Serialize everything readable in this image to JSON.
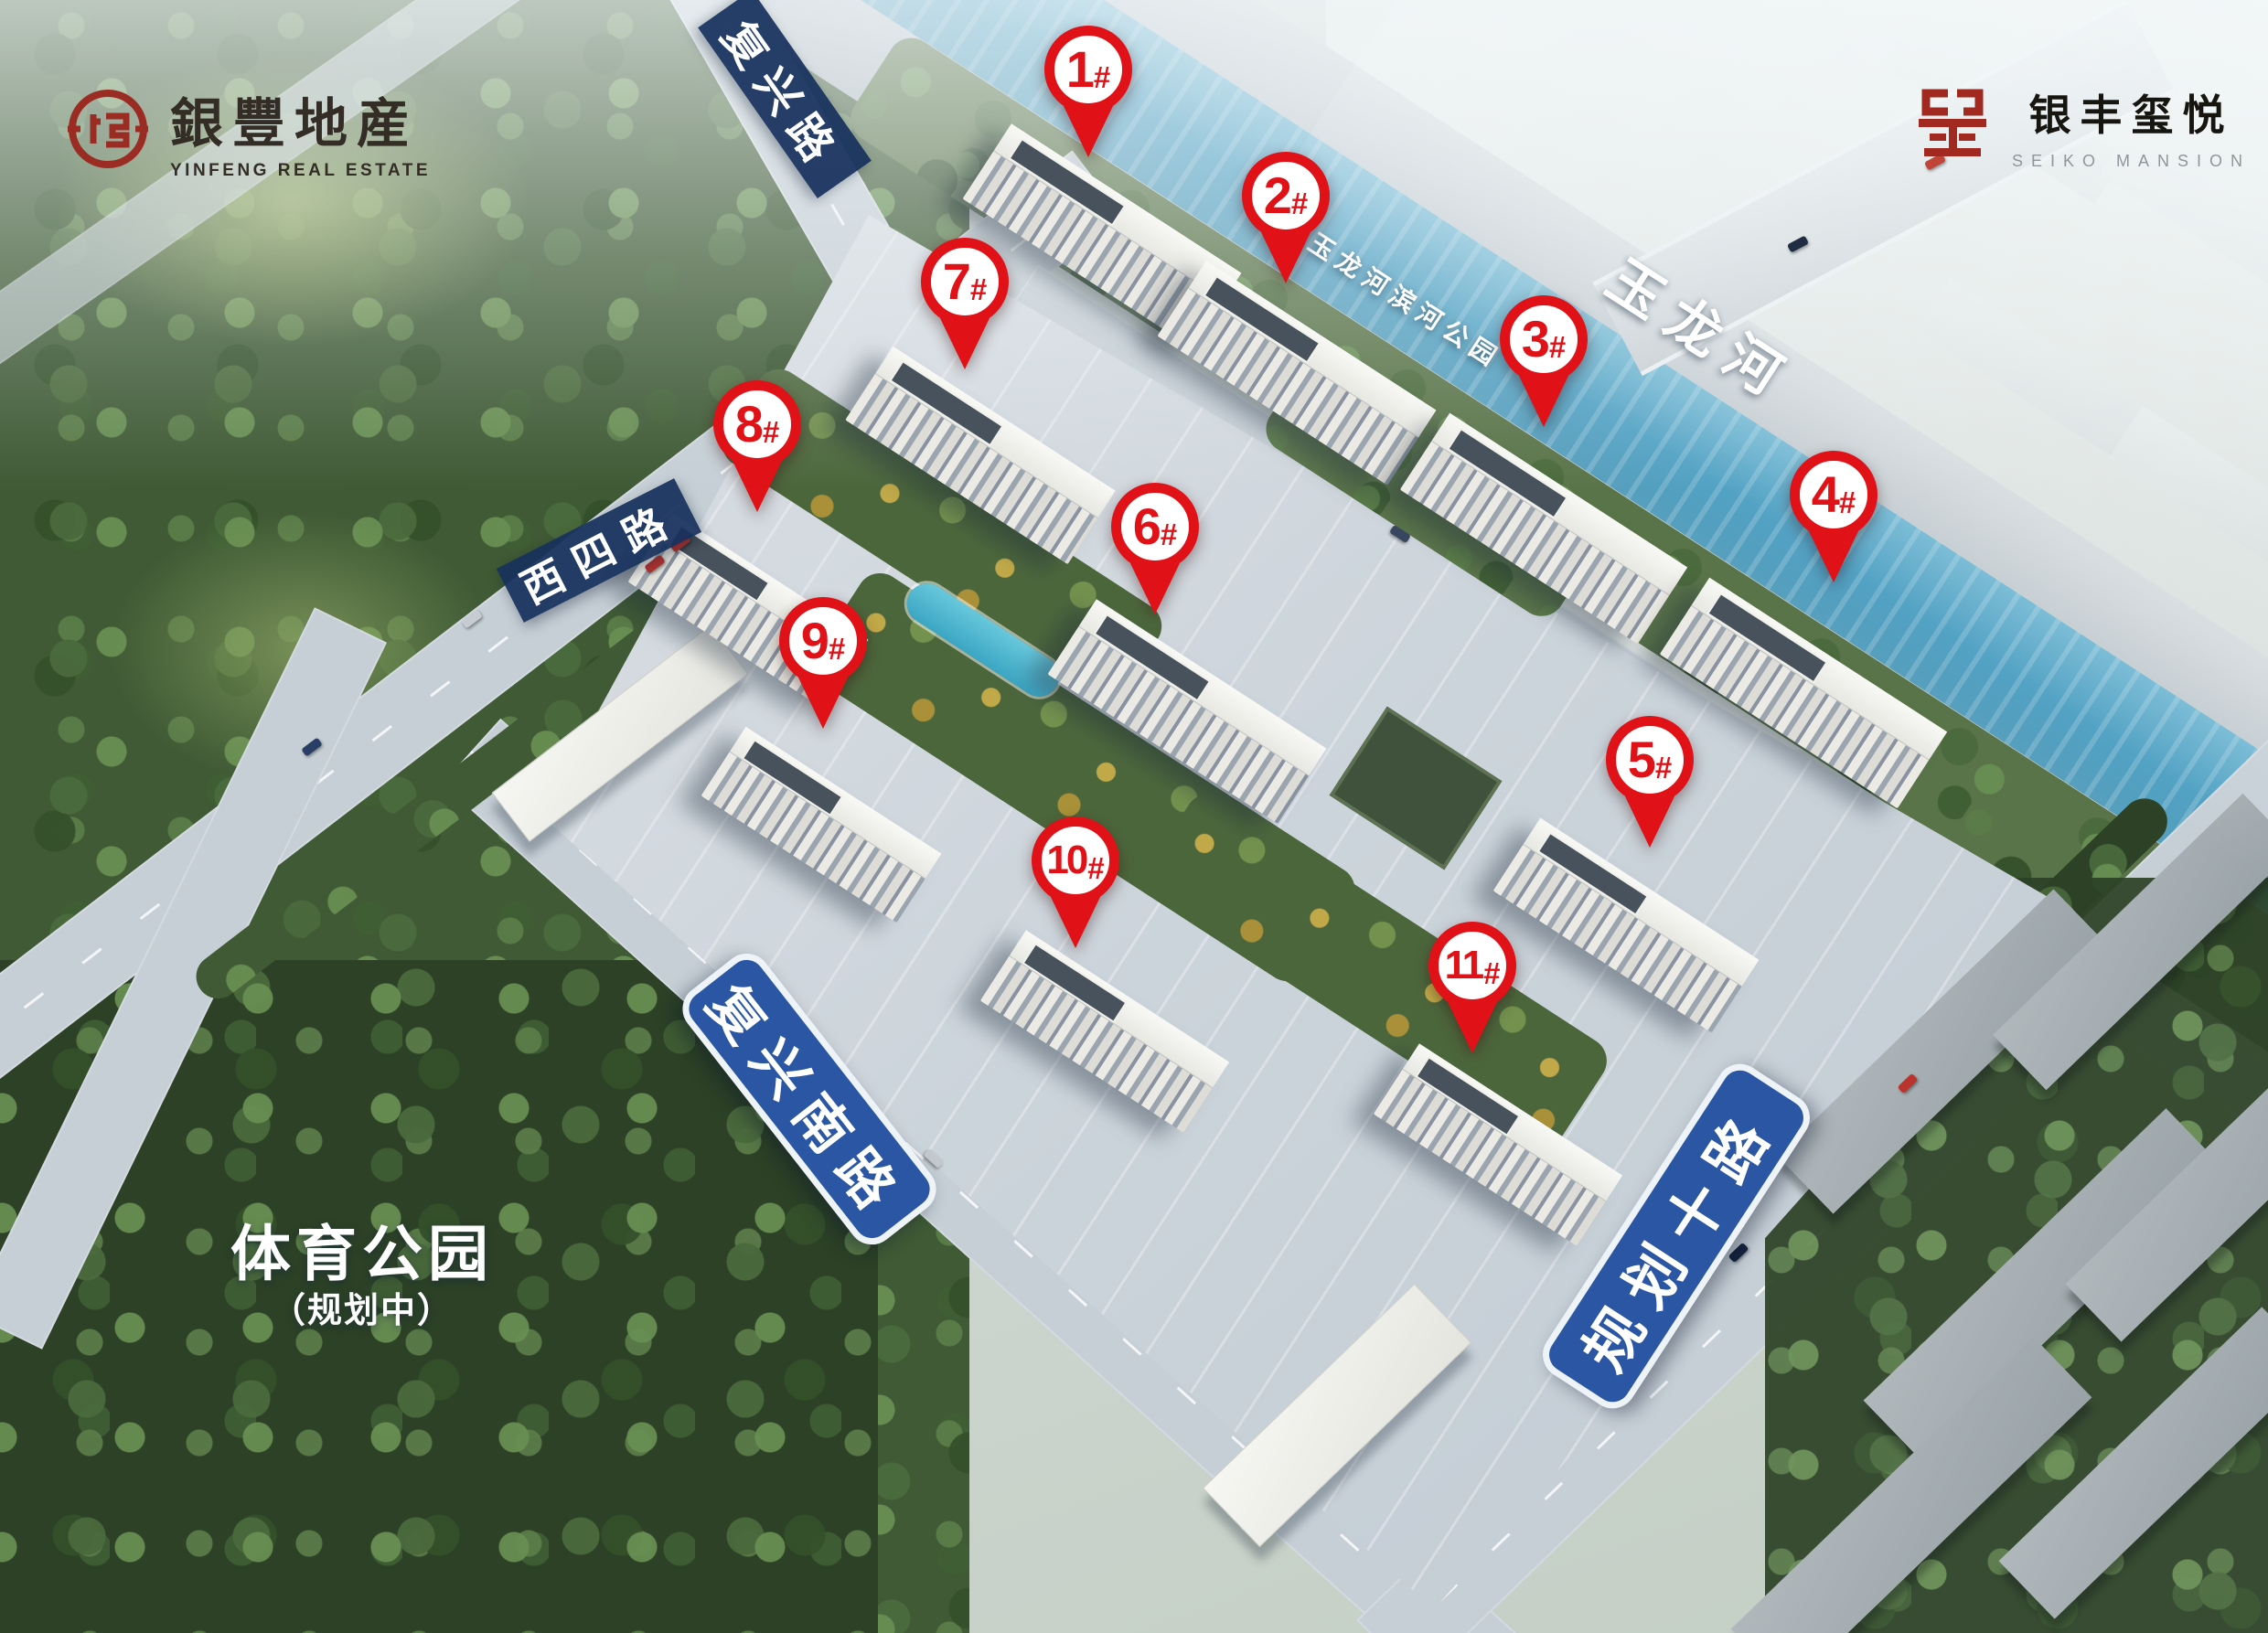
{
  "branding": {
    "developer": {
      "name_cn": "銀豐地産",
      "name_en": "YINFENG REAL ESTATE"
    },
    "project": {
      "name_cn": "银丰玺悦",
      "name_en": "SEIKO MANSION"
    }
  },
  "labels": {
    "roads": [
      {
        "id": "fuxing",
        "text": "复兴路"
      },
      {
        "id": "xisi",
        "text": "西四路"
      },
      {
        "id": "fuxingnan",
        "text": "复兴南路"
      },
      {
        "id": "guihuashi",
        "text": "规划十路"
      }
    ],
    "river": "玉龙河",
    "riverside_park": "玉龙河滨河公园",
    "sports_park": {
      "title": "体育公园",
      "subtitle": "（规划中）"
    }
  },
  "markers": [
    {
      "num": "1",
      "hash": "#"
    },
    {
      "num": "2",
      "hash": "#"
    },
    {
      "num": "3",
      "hash": "#"
    },
    {
      "num": "4",
      "hash": "#"
    },
    {
      "num": "5",
      "hash": "#"
    },
    {
      "num": "6",
      "hash": "#"
    },
    {
      "num": "7",
      "hash": "#"
    },
    {
      "num": "8",
      "hash": "#"
    },
    {
      "num": "9",
      "hash": "#"
    },
    {
      "num": "10",
      "hash": "#"
    },
    {
      "num": "11",
      "hash": "#"
    }
  ],
  "colors": {
    "pin_red": "#e01117",
    "banner_navy": "#17305c",
    "banner_blue": "#2a56a4",
    "river_blue": "#57a8c8"
  }
}
